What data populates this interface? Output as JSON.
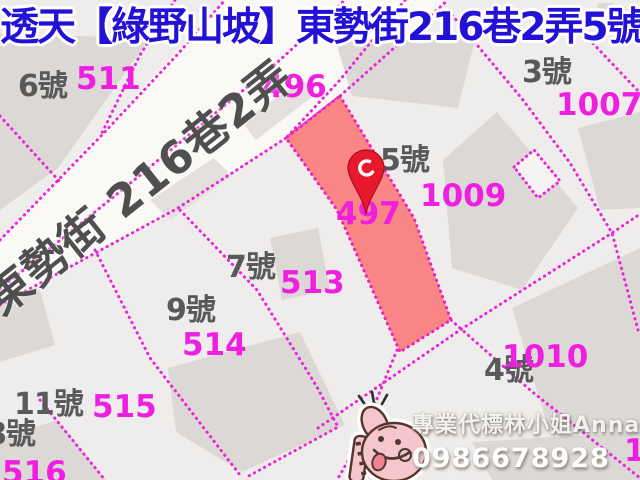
{
  "title": {
    "text": "透天【綠野山坡】東勢街216巷2弄5號"
  },
  "watermark": {
    "agent": "專業代標林小姐Anna",
    "phone": "0986678928"
  },
  "map": {
    "street": {
      "name": "東勢街 216巷2弄",
      "band_points": "0,240 225,0 448,0 420,25 340,96 286,138 178,208 0,305"
    },
    "highlight_parcel": {
      "lot_number": "497",
      "points": "340,96 414,218 451,320 400,352 337,210 286,138"
    },
    "small_parcel_outline": {
      "points": "514,167 534,150 560,181 538,198"
    },
    "house_numbers": [
      {
        "text": "6號",
        "x": 18,
        "y": 72
      },
      {
        "text": "3號",
        "x": 522,
        "y": 58
      },
      {
        "text": "5號",
        "x": 380,
        "y": 146
      },
      {
        "text": "7號",
        "x": 226,
        "y": 253
      },
      {
        "text": "9號",
        "x": 166,
        "y": 296
      },
      {
        "text": "4號",
        "x": 484,
        "y": 356
      },
      {
        "text": "11號",
        "x": 14,
        "y": 390
      },
      {
        "text": "8號",
        "x": -14,
        "y": 420
      }
    ],
    "lot_numbers": [
      {
        "text": "511",
        "x": 76,
        "y": 64
      },
      {
        "text": "496",
        "x": 262,
        "y": 72
      },
      {
        "text": "1007",
        "x": 556,
        "y": 90
      },
      {
        "text": "1009",
        "x": 420,
        "y": 181
      },
      {
        "text": "497",
        "x": 336,
        "y": 199
      },
      {
        "text": "513",
        "x": 280,
        "y": 268
      },
      {
        "text": "514",
        "x": 182,
        "y": 330
      },
      {
        "text": "515",
        "x": 92,
        "y": 392
      },
      {
        "text": "1010",
        "x": 502,
        "y": 342
      },
      {
        "text": "516",
        "x": 2,
        "y": 458
      },
      {
        "text": "10",
        "x": 624,
        "y": 436
      }
    ],
    "boundaries": [
      "0,240 100,137 177,55 225,0",
      "0,289 122,190 280,60 345,0",
      "0,305 178,208 286,138 340,96 420,25 448,0",
      "175,0 140,55 100,137",
      "0,116 60,182",
      "405,0 340,80 286,138",
      "451,320 530,390 640,478",
      "397,350 360,440 337,480",
      "318,428 460,330 612,233 640,214",
      "452,15 523,100 570,163 612,233 638,330",
      "585,35 640,93",
      "40,400 105,480",
      "95,250 150,358 240,475",
      "180,210 257,290 317,387 338,427 245,478"
    ],
    "buildings": [
      "0,34 150,38 58,168 0,210",
      "336,42 476,36 458,108 352,96",
      "443,160 497,112 578,208 522,290 452,268",
      "578,128 640,112 640,208 600,210",
      "512,308 640,248 640,428 548,428",
      "168,368 300,332 345,425 242,472 176,432",
      "0,438 58,420 106,480 0,480",
      "472,442 640,432 640,480 492,480",
      "270,238 318,228 330,290 282,300",
      "0,300 40,290 55,345 0,362",
      "598,3 614,3 612,20 596,18",
      "616,10 634,8 632,24 614,22"
    ],
    "road_smears": [
      "150,200 214,158 232,176 170,220",
      "242,122 302,80 316,94 256,140"
    ]
  },
  "theme": {
    "boundary_color": "#e926d8",
    "highlight_fill": "#f9807f",
    "building_color": "#dcd8d5",
    "background": "#efedeb",
    "title_color": "#2312d6",
    "lot_number_color": "#ee1fe0",
    "house_number_color": "#595959",
    "pin_color": "#e8192c",
    "sticker_color": "#f6c6cd"
  }
}
